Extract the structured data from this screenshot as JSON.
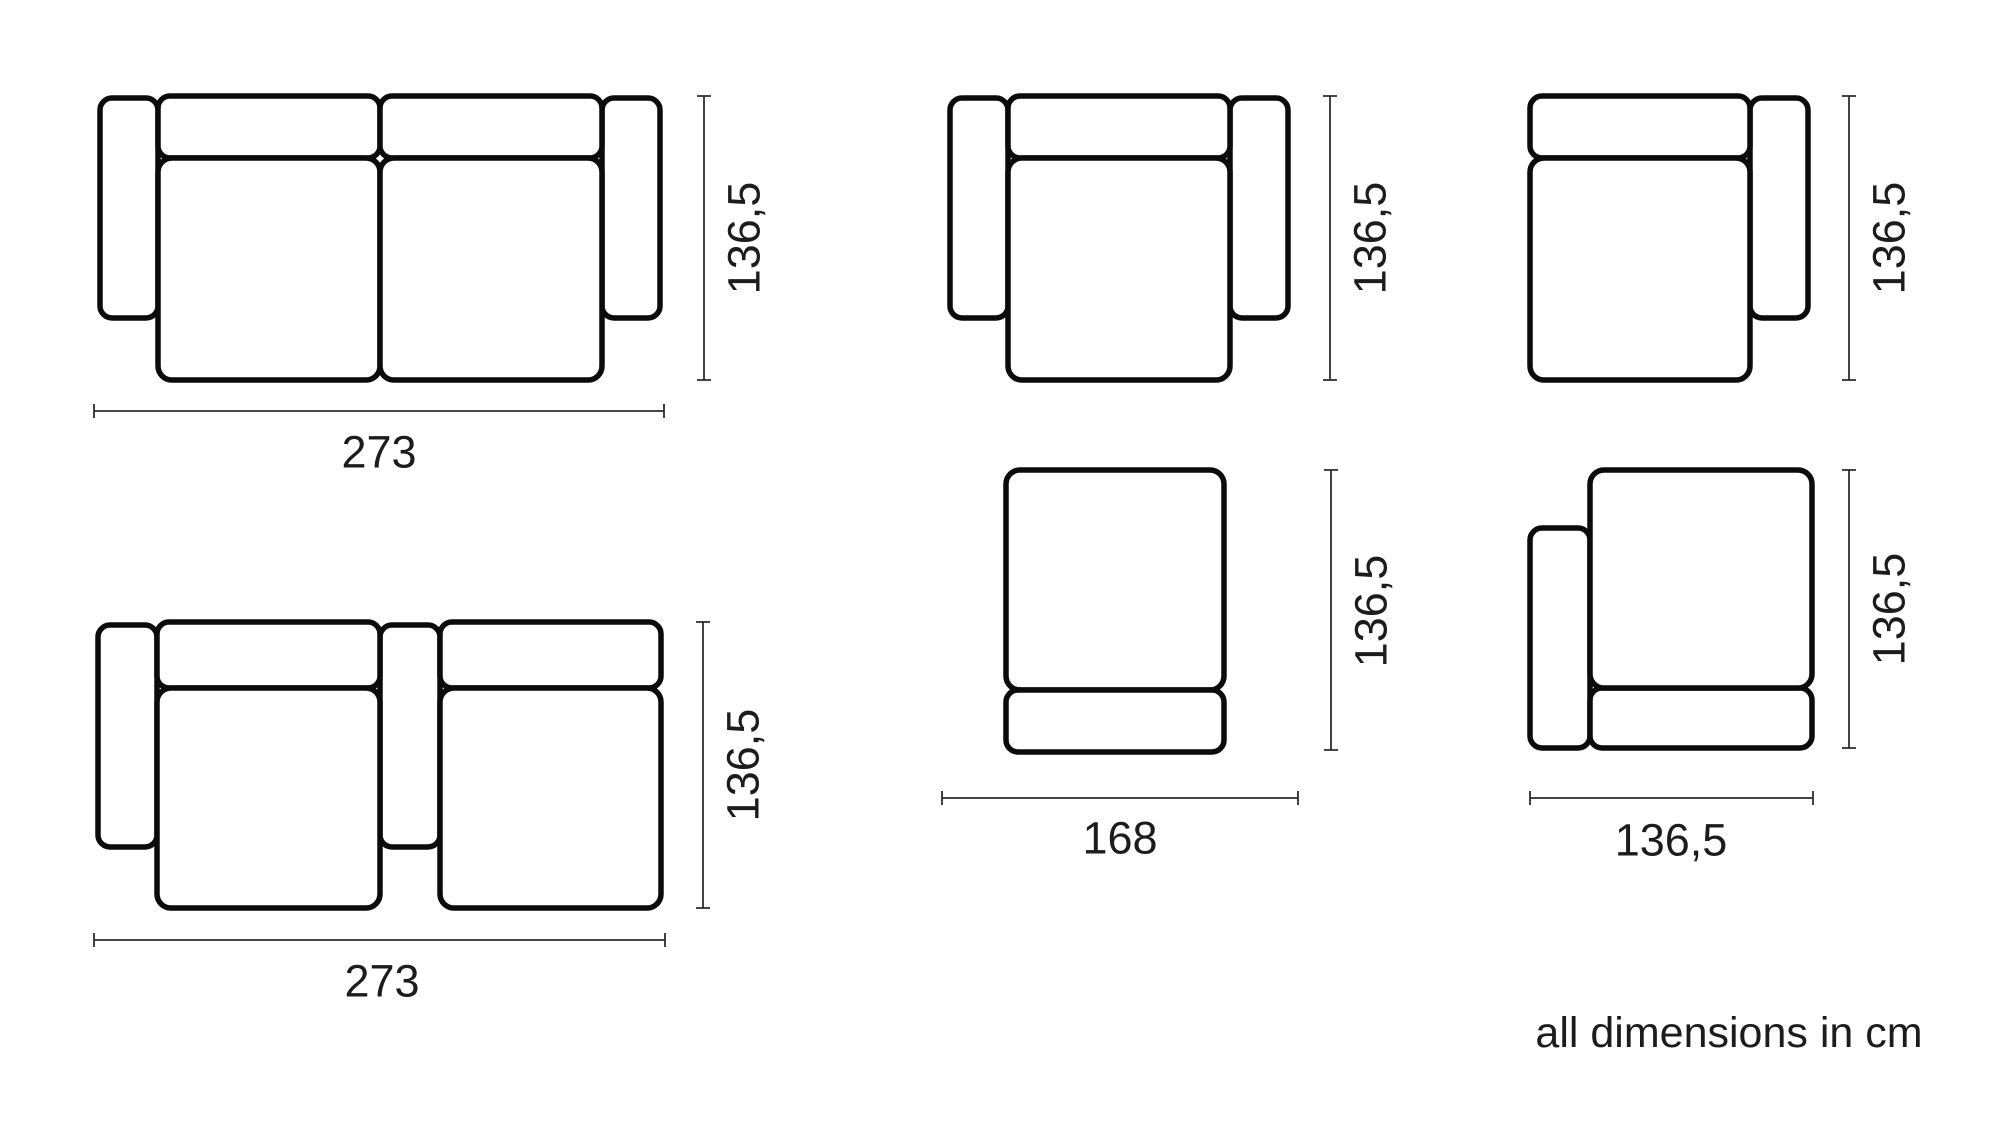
{
  "note": "all dimensions in cm",
  "labels": {
    "sofa_two_arms": {
      "width": "273",
      "depth": "136,5"
    },
    "armchair": {
      "depth": "136,5"
    },
    "module_right_arm": {
      "depth": "136,5"
    },
    "sofa_middle_arm": {
      "width": "273",
      "depth": "136,5"
    },
    "ottoman": {
      "width": "168",
      "depth": "136,5"
    },
    "module_left_arm": {
      "width": "136,5",
      "depth": "136,5"
    }
  },
  "colors": {
    "outline": "#0b0b0b",
    "dimension_line": "#2d2d2d",
    "text": "#1c1c1c",
    "background": "#ffffff"
  }
}
